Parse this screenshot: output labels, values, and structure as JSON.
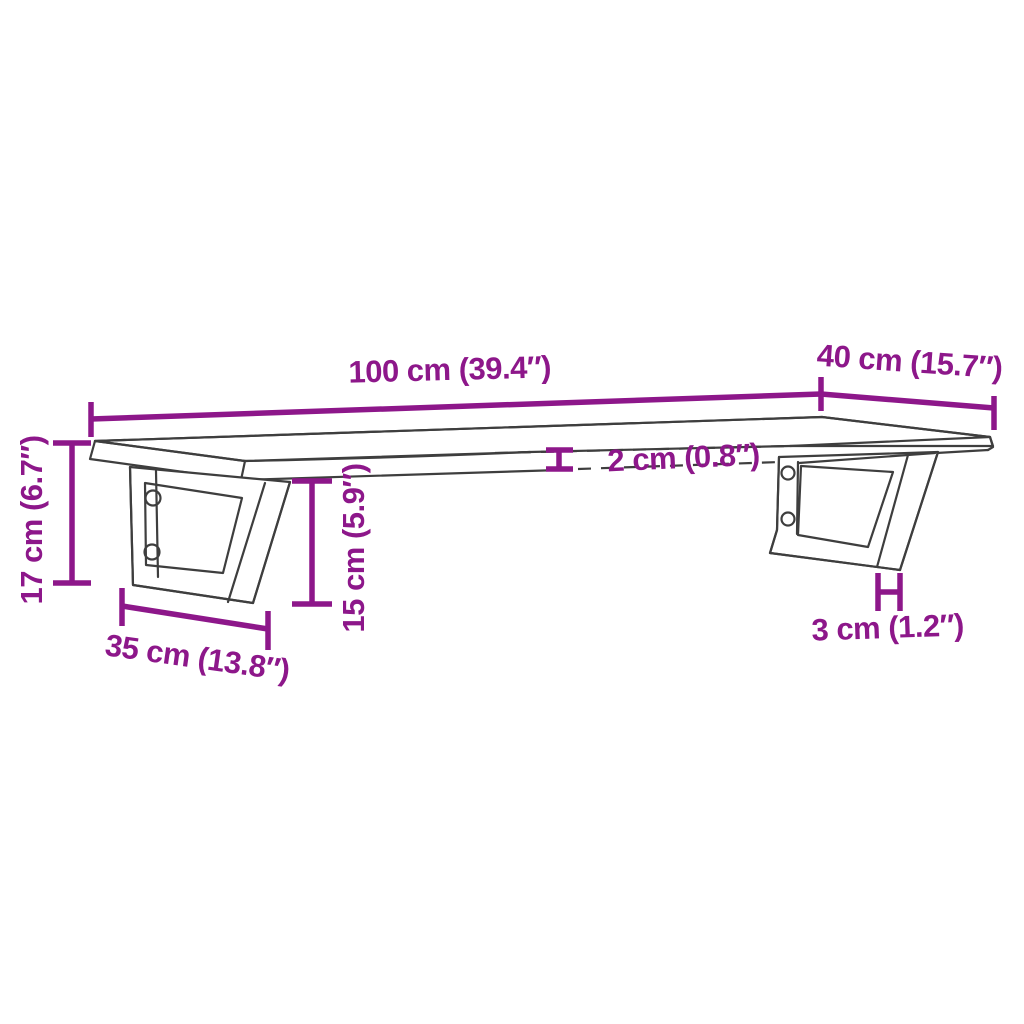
{
  "diagram": {
    "title": "Wall-mounted shelf with steel brackets — dimension drawing",
    "colors": {
      "dimension_accent": "#8d178a",
      "drawing_outline": "#3e3e3e",
      "background": "#ffffff"
    },
    "dimensions": {
      "shelf_width": {
        "value_cm": 100,
        "value_in": 39.4,
        "label": "100 cm (39.4″)"
      },
      "shelf_depth": {
        "value_cm": 40,
        "value_in": 15.7,
        "label": "40 cm (15.7″)"
      },
      "shelf_thickness": {
        "value_cm": 2,
        "value_in": 0.8,
        "label": "2 cm (0.8″)"
      },
      "total_height": {
        "value_cm": 17,
        "value_in": 6.7,
        "label": "17 cm (6.7″)"
      },
      "bracket_height": {
        "value_cm": 15,
        "value_in": 5.9,
        "label": "15 cm (5.9″)"
      },
      "bracket_depth": {
        "value_cm": 35,
        "value_in": 13.8,
        "label": "35 cm (13.8″)"
      },
      "bracket_bar_width": {
        "value_cm": 3,
        "value_in": 1.2,
        "label": "3 cm (1.2″)"
      }
    }
  }
}
